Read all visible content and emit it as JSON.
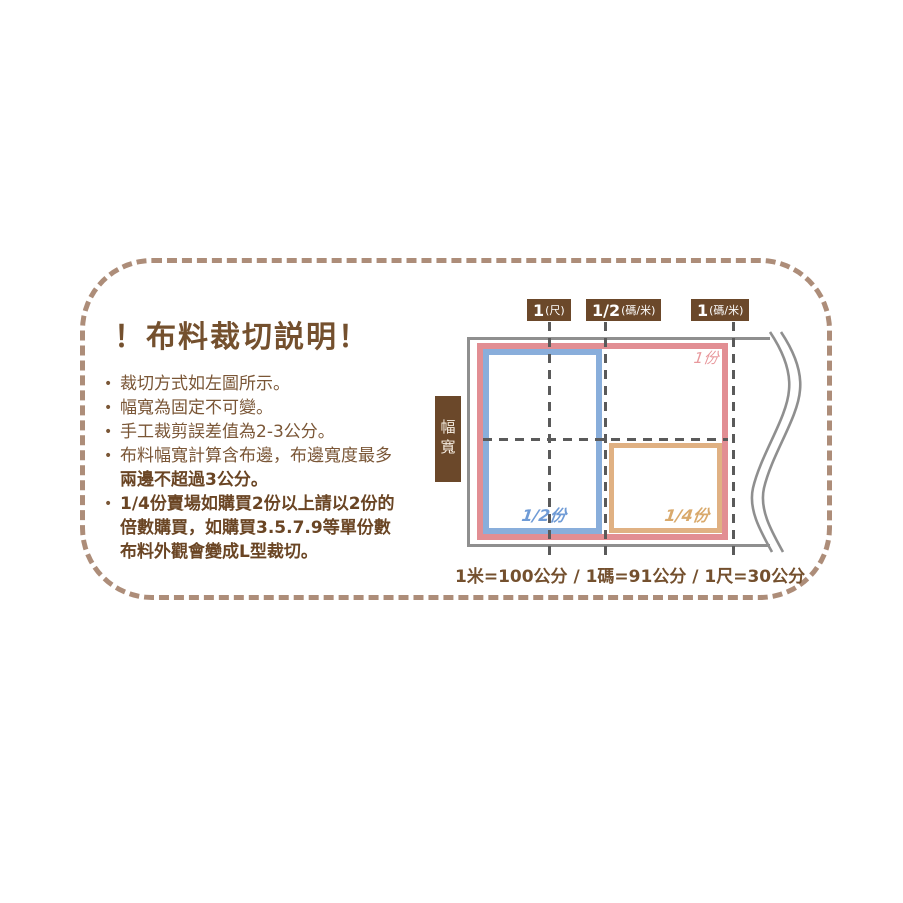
{
  "panel": {
    "bullet_glyph": "•",
    "title": "！布料裁切説明！",
    "bullets": [
      {
        "lines": [
          "裁切方式如左圖所示。"
        ]
      },
      {
        "lines": [
          "幅寬為固定不可變。"
        ]
      },
      {
        "lines": [
          "手工裁剪誤差值為2-3公分。"
        ]
      },
      {
        "lines": [
          "布料幅寬計算含布邊，布邊寬度最多",
          "兩邊不超過3公分。"
        ]
      },
      {
        "lines": [
          "1/4份賣場如購買2份以上請以2份的",
          "倍數購買，如購買3.5.7.9等單份數",
          "布料外觀會變成L型裁切。"
        ]
      }
    ]
  },
  "diagram": {
    "width_label": "幅寬",
    "top_labels": [
      {
        "value": "1",
        "unit": "(尺)"
      },
      {
        "value": "1/2",
        "unit": "(碼/米)"
      },
      {
        "value": "1",
        "unit": "(碼/米)"
      }
    ],
    "portions": {
      "one": "1份",
      "half": "1/2份",
      "quarter": "1/4份"
    },
    "conversion": "1米=100公分 / 1碼=91公分 / 1尺=30公分",
    "colors": {
      "frame_dash": "#ad8d79",
      "text_brown": "#7a5636",
      "bold_text_brown": "#6a4524",
      "label_bg_brown": "#6b482a",
      "one_unit_pink": "#e28e93",
      "half_unit_blue": "#89aedb",
      "quarter_unit_tan": "#e0b183",
      "outline_gray": "#8f8f8f",
      "cutline_gray": "#5a5a5a"
    }
  }
}
